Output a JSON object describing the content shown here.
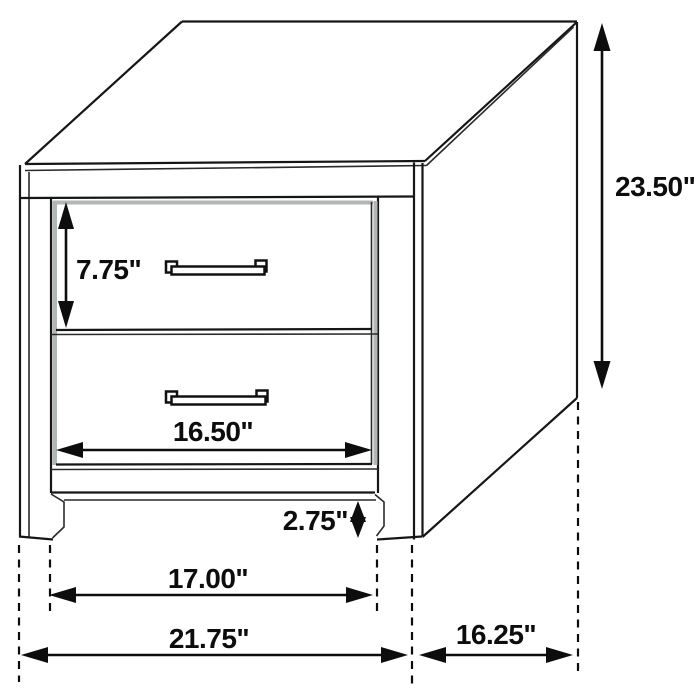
{
  "page": {
    "title": "Nightstand dimension diagram",
    "background": "#ffffff"
  },
  "diagram": {
    "item": "two-drawer nightstand line drawing",
    "style": {
      "line_color": "#161616",
      "dimension_color": "#0d0d0d",
      "inset_shadow_color": "#b2b6b6"
    },
    "dimensions": {
      "overall_height": "23.50\"",
      "drawer_opening_height": "7.75\"",
      "drawer_width": "16.50\"",
      "floor_clearance": "2.75\"",
      "leg_inner_width": "17.00\"",
      "overall_width": "21.75\"",
      "side_depth": "16.25\""
    }
  }
}
